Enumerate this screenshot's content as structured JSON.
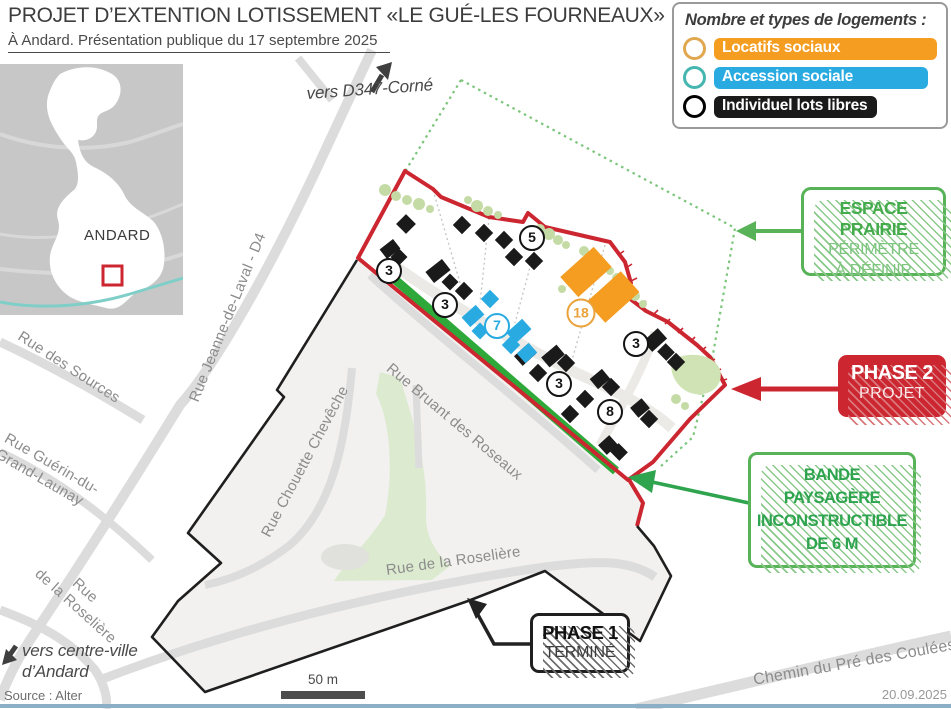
{
  "header": {
    "title": "PROJET D’EXTENTION LOTISSEMENT «LE GUÉ-LES FOURNEAUX»",
    "subtitle": "À Andard. Présentation publique du 17 septembre 2025"
  },
  "legend": {
    "title": "Nombre et types  de logements :",
    "items": [
      {
        "label": "Locatifs sociaux",
        "color": "#f49d20"
      },
      {
        "label": "Accession sociale",
        "color": "#29abe2"
      },
      {
        "label": "Individuel lots libres",
        "color": "#1a1a1a"
      }
    ]
  },
  "inset": {
    "commune": "ANDARD"
  },
  "directions": {
    "d347": "vers D347-Corné",
    "centre_line1": "vers centre-ville",
    "centre_line2": "d’Andard"
  },
  "streets": {
    "sources": "Rue des Sources",
    "jeanne": "Rue Jeanne-de-Laval - D4",
    "guerin_line1": "Rue Guérin-du-",
    "guerin_line2": "Grand-Launay",
    "chouette": "Rue Chouette Chevêche",
    "bruant": "Rue Bruant des Roseaux",
    "roseliere": "Rue de la Roselière",
    "roseliere_left_line1": "Rue",
    "roseliere_left_line2": "de la Roselière",
    "chemin": "Chemin du Pré des Coulées"
  },
  "callouts": {
    "espace": {
      "line1": "ESPACE PRAIRIE",
      "line2": "PÉRIMÈTRE",
      "line3": "À DÉFINIR"
    },
    "phase2": {
      "line1": "PHASE 2",
      "line2": "PROJET"
    },
    "bande": {
      "line1": "BANDE",
      "line2": "PAYSAGÈRE",
      "line3": "INCONSTRUCTIBLE",
      "line4": "DE 6 M"
    },
    "phase1": {
      "line1": "PHASE 1",
      "line2": "TERMINÉ"
    }
  },
  "badges": [
    {
      "value": "3",
      "type": "libre",
      "x": 389,
      "y": 271
    },
    {
      "value": "5",
      "type": "libre",
      "x": 532,
      "y": 238
    },
    {
      "value": "3",
      "type": "libre",
      "x": 445,
      "y": 305
    },
    {
      "value": "7",
      "type": "accession",
      "x": 497,
      "y": 326
    },
    {
      "value": "18",
      "type": "locatif",
      "x": 581,
      "y": 313
    },
    {
      "value": "3",
      "type": "libre",
      "x": 636,
      "y": 344
    },
    {
      "value": "3",
      "type": "libre",
      "x": 559,
      "y": 384
    },
    {
      "value": "8",
      "type": "libre",
      "x": 610,
      "y": 412
    }
  ],
  "scale": {
    "label": "50 m"
  },
  "footer": {
    "source": "Source : Alter",
    "date": "20.09.2025"
  },
  "colors": {
    "phase2_red": "#cc2630",
    "green": "#52b152",
    "bande_green": "#2fa83a",
    "orange": "#f49d20",
    "cyan": "#29abe2",
    "black_lots": "#1a1a1a",
    "road_gray": "#dcdcdc",
    "phase1_fill": "#f2f1ef",
    "inset_gray": "#c7c7c7",
    "river_blue": "#8bafc6",
    "tree_green": "#c5dba6"
  }
}
